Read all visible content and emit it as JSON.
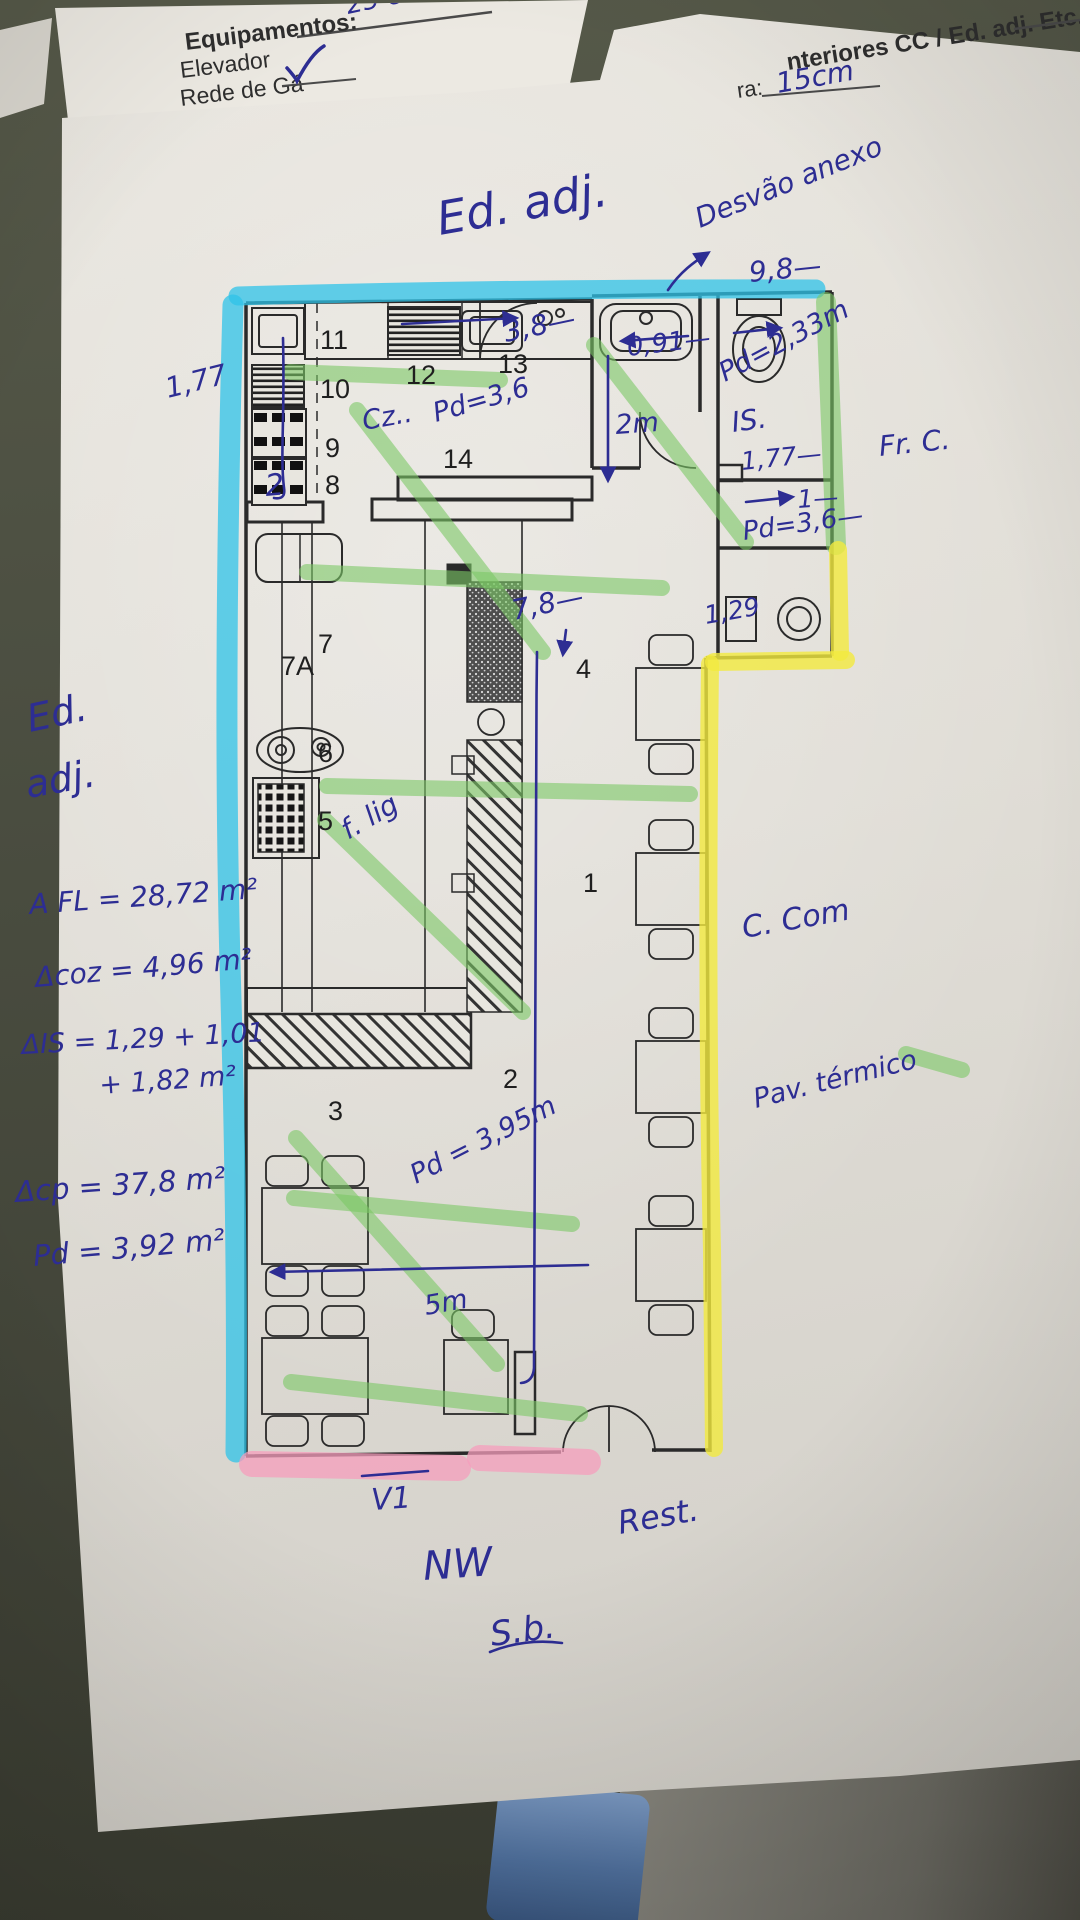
{
  "form_top_left": {
    "title": "Equipamentos:",
    "item1": "Elevador",
    "item2": "Rede de Gá",
    "note_25cm": "25 cm"
  },
  "form_top_right": {
    "heading": "nteriores CC / Ed. adj. Etc.:",
    "field_label": "ra:",
    "field_value": "15cm"
  },
  "hw": {
    "ed_adj_top": "Ed. adj.",
    "desvao_anexo": "Desvão anexo",
    "dim_98": "9,8—",
    "pd_233": "Pd=2,33m",
    "dim_091": "0,91—",
    "dim_38": "3,8—",
    "dim_2m": "2m",
    "is_label": "IS.",
    "dim_177_right": "1,77—",
    "dim_1": "1—",
    "pd_36_right": "Pd=3,6—",
    "dim_129": "1,29",
    "dim_177_left": "1,77",
    "cz": "Cz..",
    "pd_36_kitchen": "Pd=3,6",
    "dim_78": "7,8—",
    "f_lig": "f. lig",
    "ed": "Ed.",
    "adj": "adj.",
    "area_fl": "A FL = 28,72 m²",
    "area_coz": "Δcoz = 4,96 m²",
    "area_is_line1": "ΔIS = 1,29 + 1,01",
    "area_is_line2": "+ 1,82 m²",
    "area_cp": "Δcp = 37,8 m²",
    "pd_392": "Pd = 3,92 m²",
    "fr_c": "Fr. C.",
    "c_com": "C. Com",
    "pav_termico": "Pav. térmico",
    "pd_395": "Pd = 3,95m",
    "dim_5m": "5m",
    "v1": "V1",
    "rest": "Rest.",
    "nw": "NW",
    "sb": "S.b.",
    "pen_2": "2"
  },
  "plan": {
    "room_numbers": {
      "n1": "1",
      "n2": "2",
      "n3": "3",
      "n4": "4",
      "n5": "5",
      "n6": "6",
      "n7": "7",
      "n7a": "7A",
      "n8": "8",
      "n9": "9",
      "n10": "10",
      "n11": "11",
      "n12": "12",
      "n13": "13",
      "n14": "14"
    }
  },
  "colors": {
    "pen_blue": "#2d2d93",
    "highlight_cyan": "#2fc3e8",
    "highlight_green": "#7cc866",
    "highlight_yellow": "#f2ea3f",
    "highlight_pink": "#f59ebc"
  }
}
